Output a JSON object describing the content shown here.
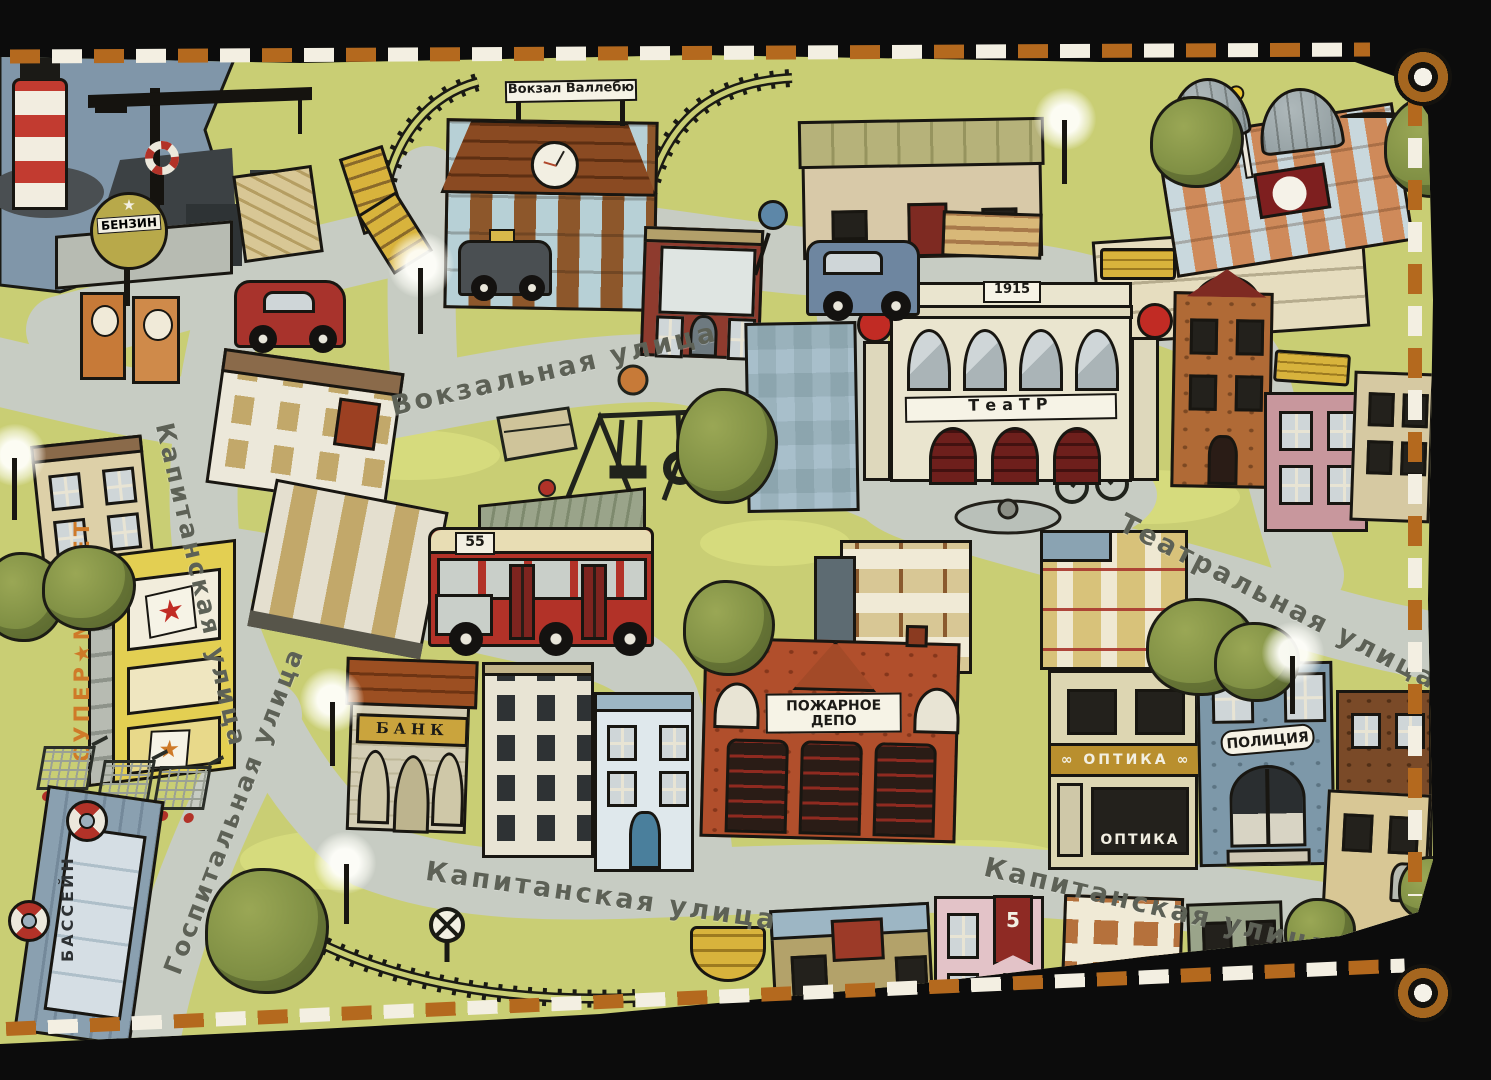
{
  "mat": {
    "streets": {
      "vokzalnaya": "Вокзальная улица",
      "teatralnaya": "Театральная улица",
      "kapitanskaya": "Капитанская улица",
      "gospitalnaya": "Госпитальная улица"
    },
    "signs": {
      "train_station": "Вокзал Валлебю",
      "theater": "ТеаТР",
      "theater_year": "1915",
      "gas_station": "БЕНЗИН",
      "gas_star": "★",
      "bank": "БАНК",
      "fire_station_line1": "ПОЖАРНОЕ",
      "fire_station_line2": "ДЕПО",
      "optics_band": "ОПТИКА",
      "optics_window": "ОПТИКА",
      "optics_glasses": "∞",
      "police": "ПОЛИЦИЯ",
      "supermarket": "СУПЕР★МАРКЕТ",
      "pool": "БАССЕЙН",
      "bus_route": "55",
      "pink_house_flag": "5",
      "price_star": "★"
    },
    "colors": {
      "grass": "#c9ce74",
      "road": "#c7ccc3",
      "water": "#8096a9",
      "mat_border": "#0c0c0c",
      "stitch_orange": "#b4691e",
      "stitch_white": "#f3efe2",
      "theater_cream": "#eae5cf",
      "fire_red": "#b14f2c",
      "bus_red": "#b23228",
      "supermarket_yellow": "#e3cf52",
      "bank_gold": "#caa43d",
      "police_blue": "#7d98a9",
      "palace_orange": "#cf8a5a"
    }
  }
}
